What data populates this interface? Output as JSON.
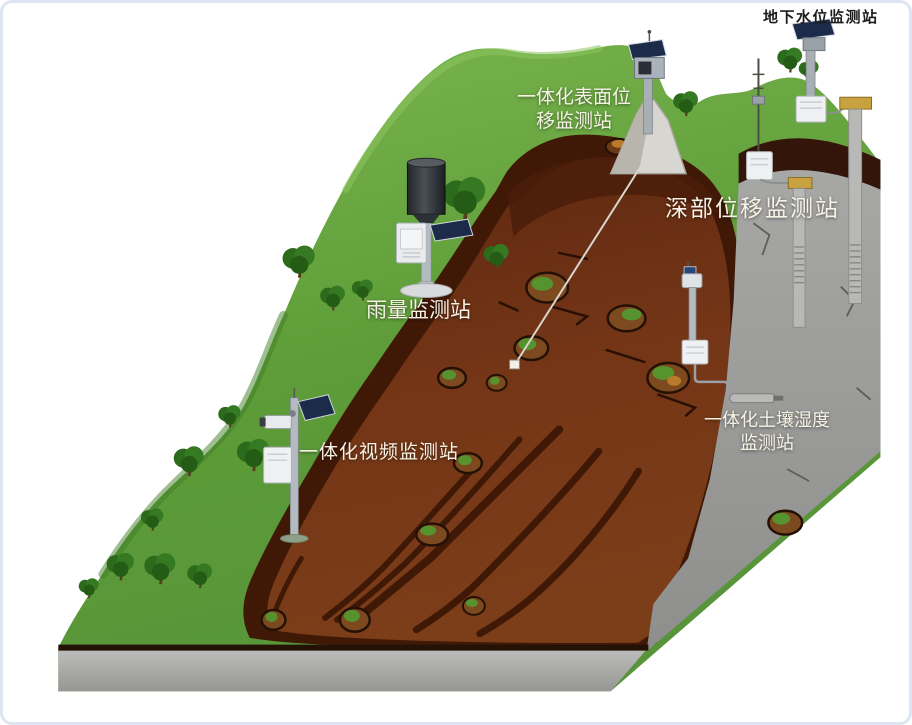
{
  "diagram": {
    "kind": "landslide-geohazard-monitoring-scene"
  },
  "stations": [
    {
      "id": "surface-displacement",
      "label_lines": [
        "一体化表面位",
        "移监测站"
      ]
    },
    {
      "id": "groundwater-level",
      "label_lines": [
        "地下水位监测站"
      ]
    },
    {
      "id": "deep-displacement",
      "label_lines": [
        "深部位移监测站"
      ]
    },
    {
      "id": "rainfall",
      "label_lines": [
        "雨量监测站"
      ]
    },
    {
      "id": "video",
      "label_lines": [
        "一体化视频监测站"
      ]
    },
    {
      "id": "soil-moisture",
      "label_lines": [
        "一体化土壤湿度",
        "监测站"
      ]
    }
  ],
  "colors": {
    "background": "#ffffff",
    "frame": "#dde5f3",
    "grass_light": "#7ab44e",
    "grass_dark": "#4a872c",
    "landslide_rim": "#3a1606",
    "landslide_body": "#6e3012",
    "rock_gray": "#9b9b99",
    "soil_line": "#241206",
    "solar_panel": "#1d2b4a",
    "equipment_box": "#eef0f2",
    "wellhead_cap": "#c8a23e",
    "label_light": "#f6f2e6",
    "label_dark": "#1c1c1c"
  }
}
